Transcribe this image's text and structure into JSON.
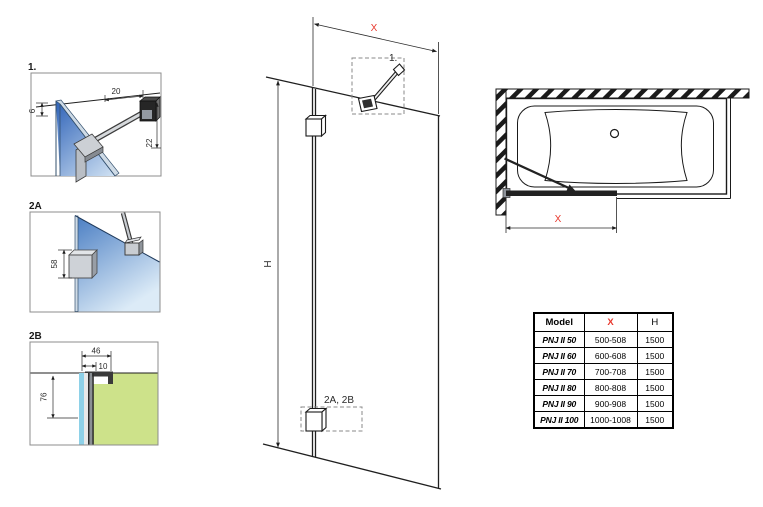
{
  "colors": {
    "accent_red": "#e8382d",
    "line": "#1f1f1f",
    "glass_dark_blue": "#2f63b8",
    "glass_light_blue": "#dcebf7",
    "wall_green": "#cde28a",
    "glass_strip_cyan": "#8ed1e8",
    "metal_gray": "#c9cdd2"
  },
  "details": {
    "d1": {
      "label": "1.",
      "dim_top": "20",
      "dim_right": "22",
      "dim_left": "6"
    },
    "d2a": {
      "label": "2A",
      "dim_left": "58"
    },
    "d2b": {
      "label": "2B",
      "dim_top": "46",
      "dim_inner": "10",
      "dim_left": "76"
    }
  },
  "elevation": {
    "dim_width": "X",
    "dim_height": "H",
    "callout_top": "1.",
    "callout_bottom": "2A, 2B"
  },
  "top_view": {
    "dim_width": "X"
  },
  "spec_table": {
    "headers": {
      "model": "Model",
      "x": "X",
      "h": "H"
    },
    "rows": [
      {
        "model": "PNJ II 50",
        "x": "500-508",
        "h": "1500"
      },
      {
        "model": "PNJ II 60",
        "x": "600-608",
        "h": "1500"
      },
      {
        "model": "PNJ II 70",
        "x": "700-708",
        "h": "1500"
      },
      {
        "model": "PNJ II 80",
        "x": "800-808",
        "h": "1500"
      },
      {
        "model": "PNJ II 90",
        "x": "900-908",
        "h": "1500"
      },
      {
        "model": "PNJ II 100",
        "x": "1000-1008",
        "h": "1500"
      }
    ]
  }
}
